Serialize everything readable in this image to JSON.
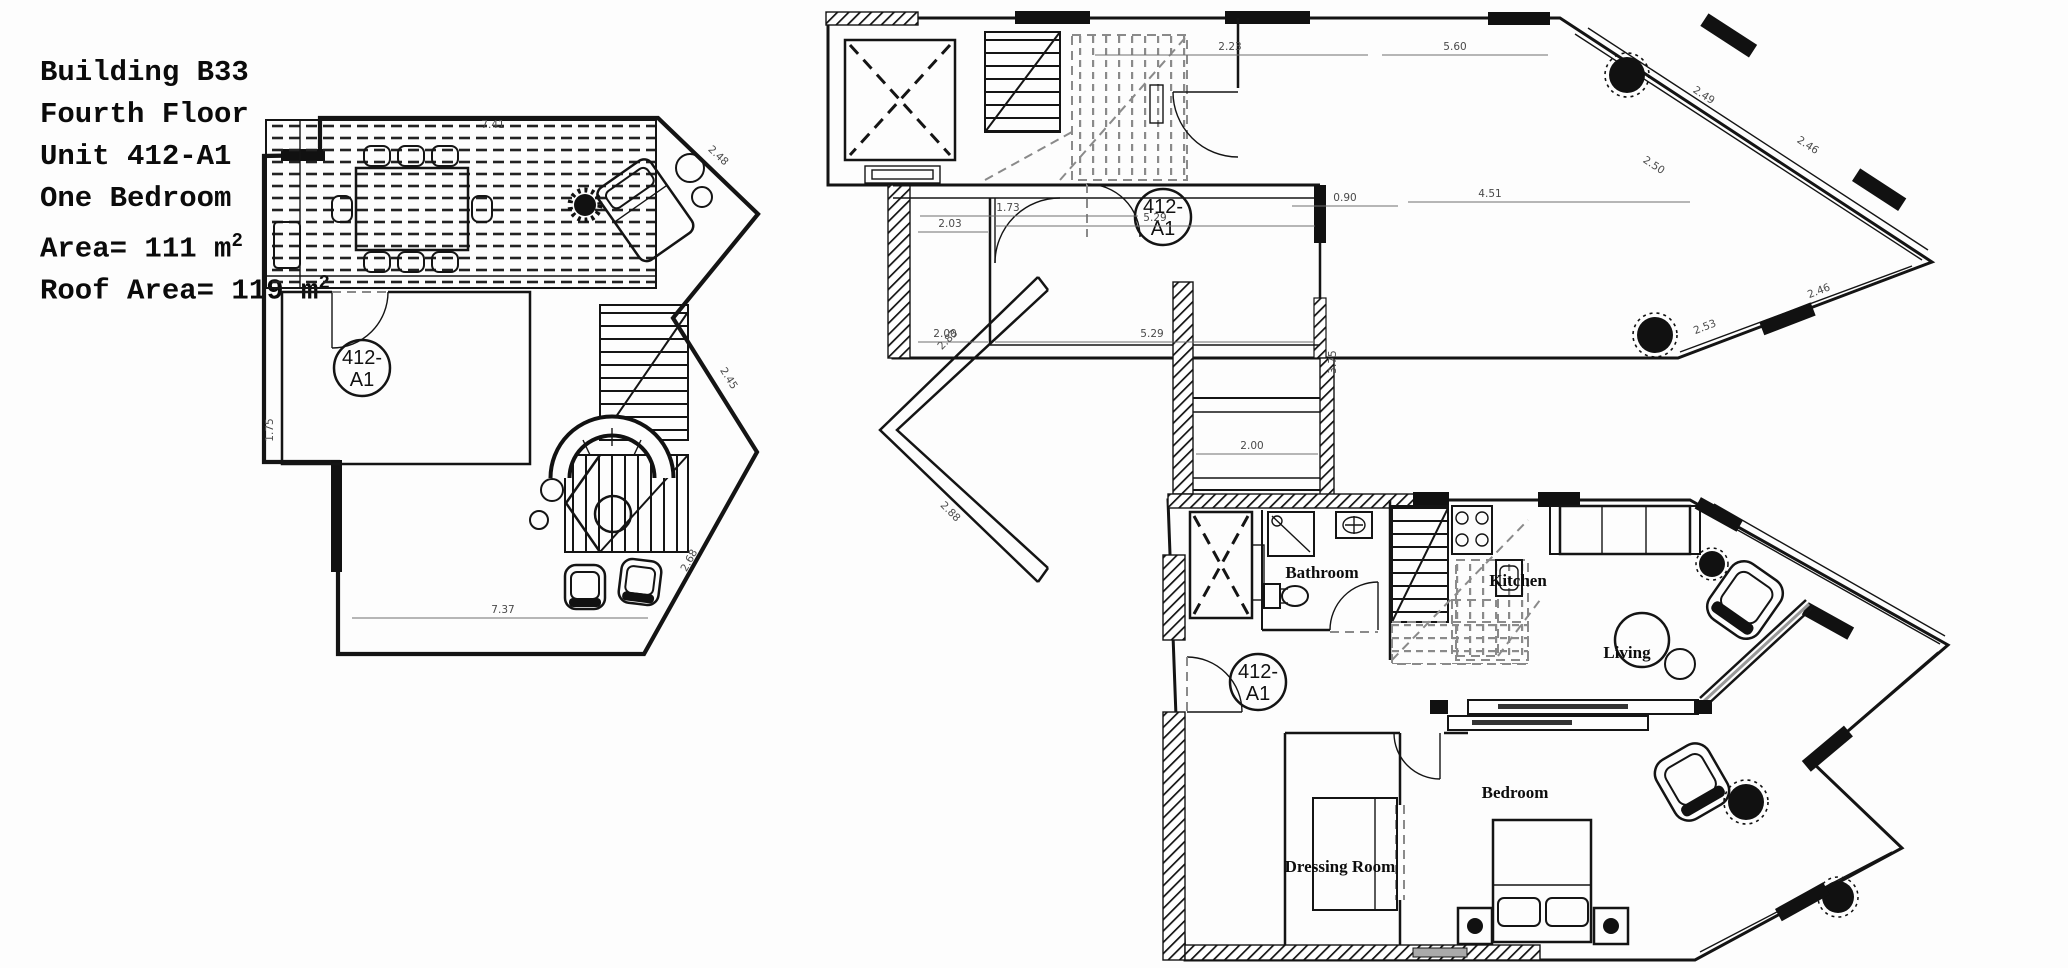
{
  "title_block": {
    "building": "Building B33",
    "floor": "Fourth Floor",
    "unit": "Unit 412-A1",
    "bedrooms": "One Bedroom",
    "area": "Area= 111 m",
    "area_sup": "2",
    "roof_area": "Roof Area= 119 m",
    "roof_area_sup": "2"
  },
  "unit_badge": {
    "line1": "412-",
    "line2": "A1"
  },
  "rooms": {
    "bathroom": "Bathroom",
    "kitchen": "Kitchen",
    "living": "Living",
    "bedroom": "Bedroom",
    "dressing_room": "Dressing Room"
  },
  "roof_plan_dims": {
    "top": "7.41",
    "left": "1.75",
    "bottom": "7.37",
    "upper_diag": "2.48",
    "mid_diag": "2.45",
    "lower_diag": "2.68"
  },
  "party_wall_dims": {
    "upper": "2.83",
    "lower": "2.88"
  },
  "upper_plan_dims": {
    "d_2_23": "2.23",
    "d_5_60": "5.60",
    "d_1_73": "1.73",
    "d_0_90": "0.90",
    "d_4_51": "4.51",
    "d_2_03": "2.03",
    "d_5_29_a": "5.29",
    "d_3_75": "3.75",
    "d_2_00_a": "2.00",
    "d_5_29_b": "5.29",
    "d_2_00_b": "2.00",
    "d_2_49": "2.49",
    "d_2_50": "2.50",
    "d_2_46_a": "2.46",
    "d_2_53": "2.53",
    "d_2_46_b": "2.46"
  },
  "colors": {
    "ink": "#141414",
    "dim_text": "#4a4a4a",
    "gray_dash": "#8a8a8a"
  }
}
